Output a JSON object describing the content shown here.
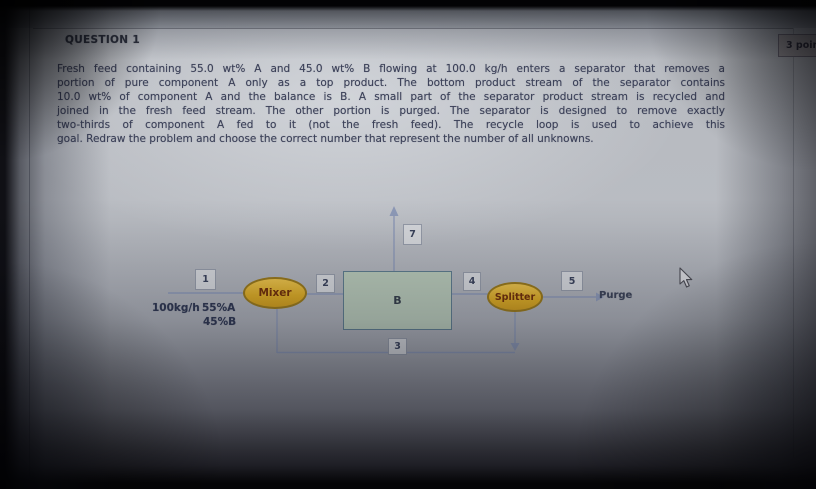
{
  "page": {
    "question_header": "QUESTION 1",
    "points_badge": "3 points"
  },
  "question": {
    "text_lines": [
      "Fresh feed containing 55.0 wt% A and 45.0 wt% B flowing at 100.0 kg/h enters a separator that removes a",
      "portion of pure component A only as a top product. The bottom product stream of the separator contains",
      "10.0 wt% of component A and the balance is B. A small part of the separator product stream is recycled and",
      "joined in the fresh feed stream. The other portion is purged. The separator is designed to remove exactly",
      "two-thirds of component A fed to it (not the fresh feed). The recycle loop is used to achieve this",
      "goal. Redraw the problem and choose the correct number that represent the number of all unknowns."
    ]
  },
  "diagram": {
    "feed_rate": "100kg/h",
    "feed_comp_a": "55%A",
    "feed_comp_b": "45%B",
    "mixer_label": "Mixer",
    "separator_label": "B",
    "splitter_label": "Splitter",
    "purge_label": "Purge",
    "stream_numbers": {
      "n1": "1",
      "n2": "2",
      "n3": "3",
      "n4": "4",
      "n5": "5",
      "n7": "7"
    }
  },
  "colors": {
    "unit_fill_gold": "#ddab22",
    "unit_border": "#997818",
    "unit_text": "#6f2d06",
    "separator_fill": "#b8c9b8",
    "separator_border": "#5d7b8d",
    "diagram_line": "#8d99b7",
    "body_text": "#3b4058",
    "page_background": "#b9bcc2"
  }
}
